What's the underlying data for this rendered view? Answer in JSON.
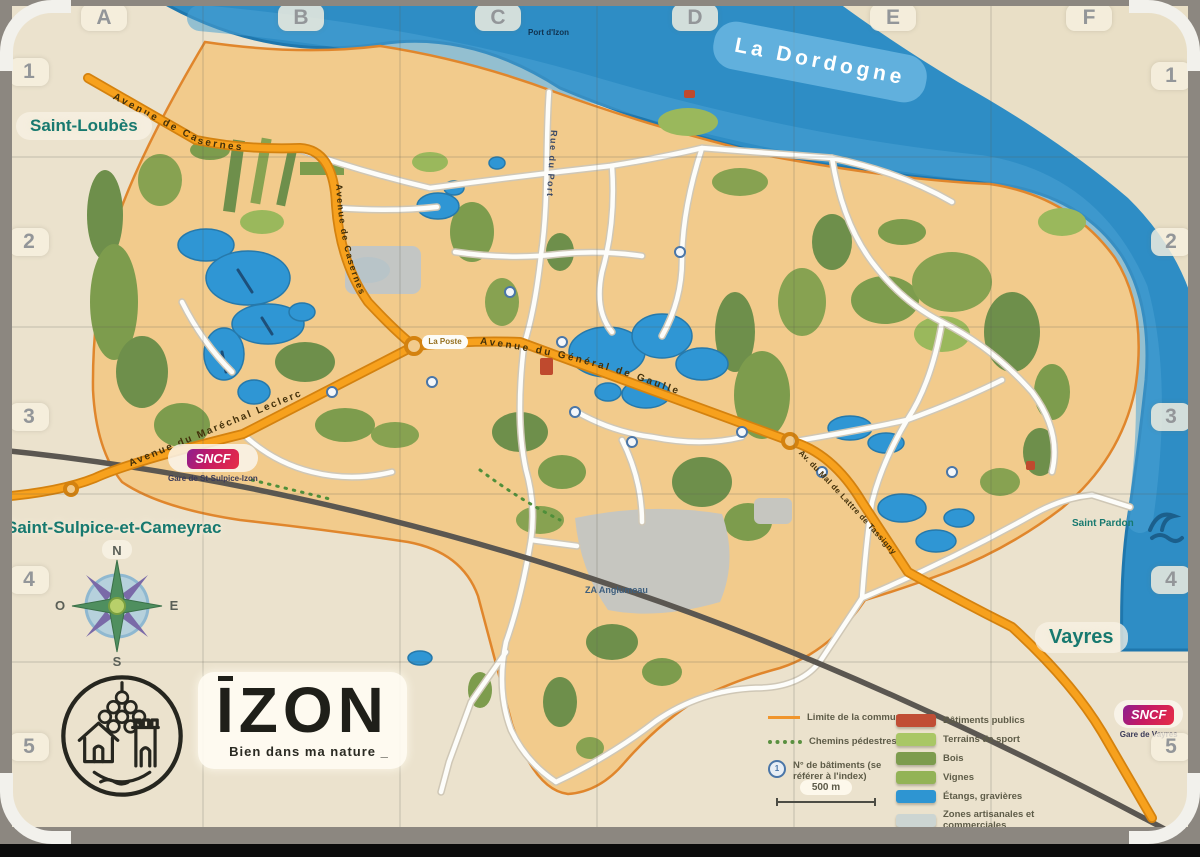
{
  "grid": {
    "cols": [
      "A",
      "B",
      "C",
      "D",
      "E",
      "F"
    ],
    "rows": [
      "1",
      "2",
      "3",
      "4",
      "5"
    ]
  },
  "river": {
    "name": "La Dordogne"
  },
  "towns": {
    "northwest": "Saint-Loubès",
    "southwest": "Saint-Sulpice-et-Cameyrac",
    "southeast": "Vayres",
    "riverside": "Saint Pardon",
    "port": "Port d'Izon"
  },
  "roads": {
    "casernes": "Avenue de Casernes",
    "leclerc": "Avenue du Maréchal Leclerc",
    "gaulle": "Avenue du Général de Gaulle",
    "tassigny": "Av. du Mal de Lattre de Tassigny",
    "port": "Rue du Port",
    "la_poste": "La Poste",
    "za": "ZA Anglumeau"
  },
  "sncf": {
    "brand": "SNCF",
    "station_left": "Gare de St-Sulpice-Izon",
    "station_right": "Gare de Vayres"
  },
  "compass": {
    "n": "N",
    "s": "S",
    "e": "E",
    "o": "O"
  },
  "logo": {
    "name": "IZON",
    "tagline": "Bien dans ma nature _"
  },
  "legend": {
    "items_left": [
      {
        "label": "Limite de la commune"
      },
      {
        "label": "Chemins pédestres"
      },
      {
        "label": "N° de bâtiments (se référer à l'index)",
        "icon_number": "1"
      }
    ],
    "scale_label": "500 m",
    "items_right": [
      {
        "label": "Bâtiments publics",
        "color": "#c14e35"
      },
      {
        "label": "Terrains de sport",
        "color": "#a9c765"
      },
      {
        "label": "Bois",
        "color": "#7d9c4d"
      },
      {
        "label": "Vignes",
        "color": "#93b356"
      },
      {
        "label": "Étangs, gravières",
        "color": "#2e95d2"
      },
      {
        "label": "Zones artisanales et commerciales",
        "color": "#ccd5d2"
      }
    ]
  },
  "colors": {
    "river": "#2e8dc5",
    "commune": "#f2cb8c",
    "orange_road": "#f7a11d",
    "teal_label": "#17796f",
    "railway": "#5b5751"
  }
}
